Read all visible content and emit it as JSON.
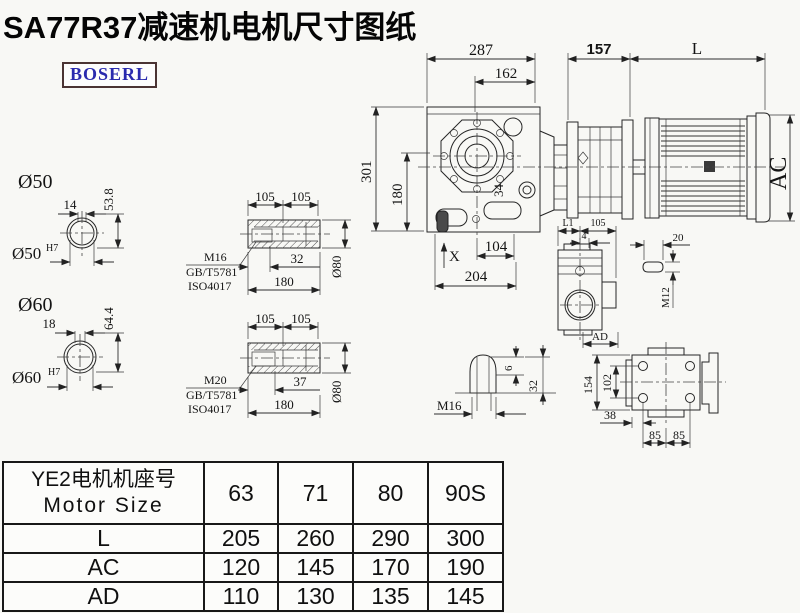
{
  "title": "SA77R37减速机电机尺寸图纸",
  "logo": "BOSERL",
  "main": {
    "d287": "287",
    "d162": "162",
    "d157": "157",
    "dL": "L",
    "dAC": "AC",
    "d301": "301",
    "d180": "180",
    "d34": "34",
    "dX": "X",
    "d104": "104",
    "d204": "204"
  },
  "bore50": {
    "title": "Ø50",
    "key_w": "14",
    "h": "53.8",
    "fit": "Ø50",
    "fit_sup": "H7"
  },
  "bore60": {
    "title": "Ø60",
    "key_w": "18",
    "h": "64.4",
    "fit": "Ø60",
    "fit_sup": "H7"
  },
  "sleeve1": {
    "p1": "105",
    "p2": "105",
    "thread": "M16",
    "std1": "GB/T5781",
    "std2": "ISO4017",
    "depth": "32",
    "len": "180",
    "dia": "Ø80"
  },
  "sleeve2": {
    "p1": "105",
    "p2": "105",
    "thread": "M20",
    "std1": "GB/T5781",
    "std2": "ISO4017",
    "depth": "37",
    "len": "180",
    "dia": "Ø80"
  },
  "plug": {
    "thread": "M16",
    "d6": "6",
    "d32": "32"
  },
  "side": {
    "dL1": "L1",
    "d105": "105",
    "d4": "4",
    "dAD": "AD",
    "d20": "20",
    "thread": "M12"
  },
  "back": {
    "d154": "154",
    "d102": "102",
    "d38": "38",
    "d85a": "85",
    "d85b": "85"
  },
  "table": {
    "header_cn": "YE2电机机座号",
    "header_en": "Motor Size",
    "sizes": [
      "63",
      "71",
      "80",
      "90S"
    ],
    "rows": [
      {
        "label": "L",
        "values": [
          "205",
          "260",
          "290",
          "300"
        ]
      },
      {
        "label": "AC",
        "values": [
          "120",
          "145",
          "170",
          "190"
        ]
      },
      {
        "label": "AD",
        "values": [
          "110",
          "130",
          "135",
          "145"
        ]
      }
    ]
  }
}
